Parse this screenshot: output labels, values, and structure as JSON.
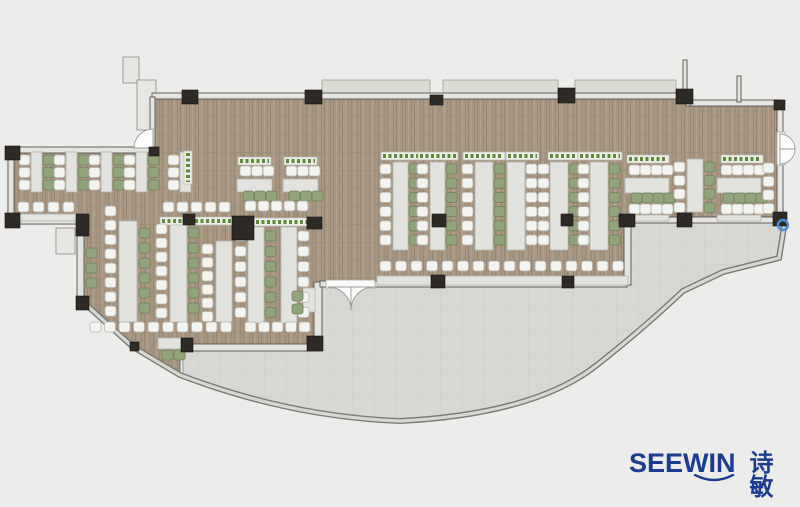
{
  "logo": {
    "brand": "SEEWIN",
    "cjk": "诗敏",
    "color": "#1c3c90"
  },
  "palette": {
    "background": "#ececea",
    "floor": "#a79682",
    "floor_grain": "#9a English8874",
    "terrace": "#d7d7d4",
    "wall_fill": "#e4e4e0",
    "wall_line": "#57544f",
    "glass_dark": "#7c7a76",
    "glass_light": "#d8d8d3",
    "column": "#2e2b27",
    "canopy": "#dcdcd5",
    "table": "#e2e2de",
    "table_line": "#b6b4ae",
    "chair_white": "#f3f3f0",
    "chair_white_line": "#b8b6b0",
    "chair_green": "#92a37c",
    "chair_green_line": "#6f815c",
    "plant_dot": "#5c8a39",
    "plant_strip": "#edeee8",
    "marker_blue": "#4b8fd5",
    "logo_blue": "#1c3c90"
  },
  "floorplan": {
    "floor_path": "M152,97 L690,97 L690,103 L782,103 L782,218 L630,218 L630,284 L322,284 L322,347 L180,347 L180,375 L133,347 L82,301 L82,224 L8,224 L8,148 L152,148 Z",
    "terrace_path": "M183,348 L320,348 L320,285 L630,285 L630,221 L785,221 L779,258 L723,272 L683,291 Q645,327 597,365 Q535,414 400,421 Q290,417 183,375 Z",
    "glass_path": "M82,301 L133,347 L180,375 Q290,417 400,421 Q535,414 597,365 Q645,327 683,291 L723,272 L779,258 L785,221",
    "walls": [
      [
        152,
        93,
        538,
        6
      ],
      [
        686,
        93,
        4,
        13
      ],
      [
        690,
        100,
        92,
        6
      ],
      [
        683,
        60,
        4,
        35
      ],
      [
        737,
        76,
        4,
        26
      ],
      [
        777,
        104,
        6,
        30
      ],
      [
        777,
        163,
        6,
        51
      ],
      [
        150,
        97,
        5,
        51
      ],
      [
        8,
        147,
        146,
        6
      ],
      [
        8,
        147,
        6,
        77
      ],
      [
        8,
        218,
        75,
        6
      ],
      [
        77,
        223,
        7,
        76
      ],
      [
        186,
        344,
        134,
        7
      ],
      [
        314,
        282,
        8,
        68
      ],
      [
        320,
        281,
        9,
        6
      ],
      [
        374,
        281,
        253,
        6
      ],
      [
        624,
        221,
        7,
        64
      ],
      [
        630,
        217,
        145,
        6
      ]
    ],
    "canopies": [
      [
        322,
        80,
        108,
        14
      ],
      [
        443,
        80,
        115,
        14
      ],
      [
        575,
        80,
        101,
        14
      ]
    ],
    "misc_rects": [
      [
        123,
        57,
        16,
        26
      ],
      [
        137,
        80,
        19,
        50
      ],
      [
        56,
        228,
        19,
        26
      ]
    ],
    "doors": {
      "openings": [
        [
          326,
          280,
          49,
          8
        ],
        [
          777,
          132,
          8,
          33
        ]
      ],
      "leaves": [
        "M328,287 A23,23 0 0 1 351,310 L351,287 Z",
        "M374,287 A23,23 0 0 0 351,310 L351,287 Z",
        "M780,134 A15,15 0 0 1 795,149 L780,149 Z",
        "M780,164 A15,15 0 0 0 795,149 L780,149 Z",
        "M153,129 A19,19 0 0 0 134,148 L153,148 Z"
      ]
    },
    "tables": [
      [
        31,
        152,
        11,
        40
      ],
      [
        66,
        152,
        11,
        40
      ],
      [
        101,
        152,
        11,
        40
      ],
      [
        136,
        152,
        11,
        40
      ],
      [
        180,
        152,
        11,
        40
      ],
      [
        16,
        214,
        62,
        7
      ],
      [
        119,
        221,
        18,
        101
      ],
      [
        170,
        221,
        17,
        101
      ],
      [
        216,
        241,
        16,
        81
      ],
      [
        237,
        179,
        35,
        13
      ],
      [
        283,
        179,
        35,
        13
      ],
      [
        248,
        227,
        16,
        96
      ],
      [
        281,
        227,
        16,
        96
      ],
      [
        303,
        288,
        12,
        24
      ],
      [
        158,
        338,
        24,
        11
      ],
      [
        393,
        162,
        15,
        88
      ],
      [
        430,
        162,
        15,
        88
      ],
      [
        475,
        162,
        18,
        88
      ],
      [
        507,
        162,
        18,
        88
      ],
      [
        550,
        162,
        18,
        88
      ],
      [
        590,
        162,
        18,
        88
      ],
      [
        377,
        276,
        251,
        9
      ],
      [
        625,
        178,
        44,
        15
      ],
      [
        625,
        215,
        44,
        6
      ],
      [
        687,
        159,
        16,
        53
      ],
      [
        717,
        178,
        44,
        15
      ],
      [
        717,
        215,
        44,
        6
      ]
    ],
    "plants_h": [
      [
        160,
        217,
        76
      ],
      [
        238,
        157,
        33
      ],
      [
        284,
        157,
        33
      ],
      [
        243,
        218,
        72
      ],
      [
        381,
        152,
        40
      ],
      [
        418,
        152,
        40
      ],
      [
        463,
        152,
        42
      ],
      [
        506,
        152,
        33
      ],
      [
        548,
        152,
        40
      ],
      [
        578,
        152,
        44
      ],
      [
        627,
        155,
        42
      ],
      [
        721,
        155,
        42
      ]
    ],
    "plants_v": [
      [
        184,
        151,
        33
      ]
    ],
    "chair_rows": [
      [
        18,
        202,
        4,
        15,
        "w"
      ],
      [
        163,
        202,
        5,
        14,
        "w"
      ],
      [
        90,
        322,
        10,
        14.5,
        "w"
      ],
      [
        240,
        166,
        3,
        11.5,
        "w"
      ],
      [
        243,
        191,
        3,
        11.5,
        "g"
      ],
      [
        286,
        166,
        3,
        11.5,
        "w"
      ],
      [
        289,
        191,
        3,
        11.5,
        "g"
      ],
      [
        245,
        201,
        5,
        13,
        "w"
      ],
      [
        245,
        322,
        5,
        13.5,
        "w"
      ],
      [
        162,
        350,
        2,
        12,
        "g"
      ],
      [
        380,
        261,
        16,
        15.5,
        "w"
      ],
      [
        629,
        165,
        4,
        11,
        "w"
      ],
      [
        631,
        193,
        4,
        11,
        "g"
      ],
      [
        629,
        204,
        4,
        11,
        "w"
      ],
      [
        721,
        165,
        4,
        11,
        "w"
      ],
      [
        723,
        193,
        4,
        11,
        "g"
      ],
      [
        721,
        204,
        4,
        11,
        "w"
      ]
    ],
    "chair_cols": [
      [
        19,
        155,
        3,
        12.5,
        "w"
      ],
      [
        43,
        155,
        3,
        12.5,
        "g"
      ],
      [
        54,
        155,
        3,
        12.5,
        "w"
      ],
      [
        78,
        155,
        3,
        12.5,
        "g"
      ],
      [
        89,
        155,
        3,
        12.5,
        "w"
      ],
      [
        113,
        155,
        3,
        12.5,
        "g"
      ],
      [
        124,
        155,
        3,
        12.5,
        "w"
      ],
      [
        148,
        155,
        3,
        12.5,
        "g"
      ],
      [
        168,
        155,
        3,
        12.5,
        "w"
      ],
      [
        86,
        248,
        3,
        15,
        "g"
      ],
      [
        105,
        206,
        8,
        14.3,
        "w"
      ],
      [
        139,
        228,
        6,
        15,
        "g"
      ],
      [
        156,
        224,
        7,
        14,
        "w"
      ],
      [
        188,
        228,
        6,
        15,
        "g"
      ],
      [
        202,
        244,
        6,
        13.5,
        "w"
      ],
      [
        235,
        231,
        6,
        15.3,
        "w"
      ],
      [
        265,
        231,
        6,
        15.3,
        "g"
      ],
      [
        298,
        231,
        6,
        15.3,
        "w"
      ],
      [
        292,
        291,
        2,
        13,
        "g"
      ],
      [
        380,
        164,
        6,
        14.2,
        "w"
      ],
      [
        409,
        164,
        6,
        14.2,
        "g"
      ],
      [
        417,
        164,
        6,
        14.2,
        "w"
      ],
      [
        446,
        164,
        6,
        14.2,
        "g"
      ],
      [
        462,
        164,
        6,
        14.2,
        "w"
      ],
      [
        494,
        164,
        6,
        14.2,
        "g"
      ],
      [
        526,
        164,
        6,
        14.2,
        "w"
      ],
      [
        538,
        164,
        6,
        14.2,
        "w"
      ],
      [
        569,
        164,
        6,
        14.2,
        "g"
      ],
      [
        578,
        164,
        6,
        14.2,
        "w"
      ],
      [
        609,
        164,
        6,
        14.2,
        "g"
      ],
      [
        674,
        162,
        4,
        13.5,
        "w"
      ],
      [
        704,
        162,
        4,
        13.5,
        "g"
      ],
      [
        763,
        163,
        4,
        13.5,
        "w"
      ]
    ],
    "columns": [
      [
        182,
        90,
        16,
        14
      ],
      [
        305,
        90,
        17,
        14
      ],
      [
        430,
        95,
        13,
        10
      ],
      [
        558,
        88,
        17,
        15
      ],
      [
        676,
        89,
        17,
        15
      ],
      [
        5,
        146,
        15,
        14
      ],
      [
        5,
        213,
        15,
        15
      ],
      [
        76,
        214,
        13,
        22
      ],
      [
        76,
        296,
        13,
        14
      ],
      [
        149,
        147,
        10,
        9
      ],
      [
        183,
        214,
        12,
        11
      ],
      [
        232,
        216,
        22,
        24
      ],
      [
        307,
        217,
        15,
        12
      ],
      [
        432,
        214,
        14,
        13
      ],
      [
        561,
        214,
        12,
        12
      ],
      [
        619,
        214,
        16,
        13
      ],
      [
        677,
        213,
        15,
        14
      ],
      [
        773,
        212,
        14,
        14
      ],
      [
        181,
        338,
        12,
        14
      ],
      [
        307,
        336,
        16,
        15
      ],
      [
        431,
        275,
        14,
        13
      ],
      [
        562,
        276,
        12,
        12
      ],
      [
        130,
        342,
        9,
        9
      ],
      [
        774,
        100,
        11,
        10
      ]
    ],
    "blue_marker": {
      "cx": 783,
      "cy": 225,
      "r": 5
    }
  }
}
